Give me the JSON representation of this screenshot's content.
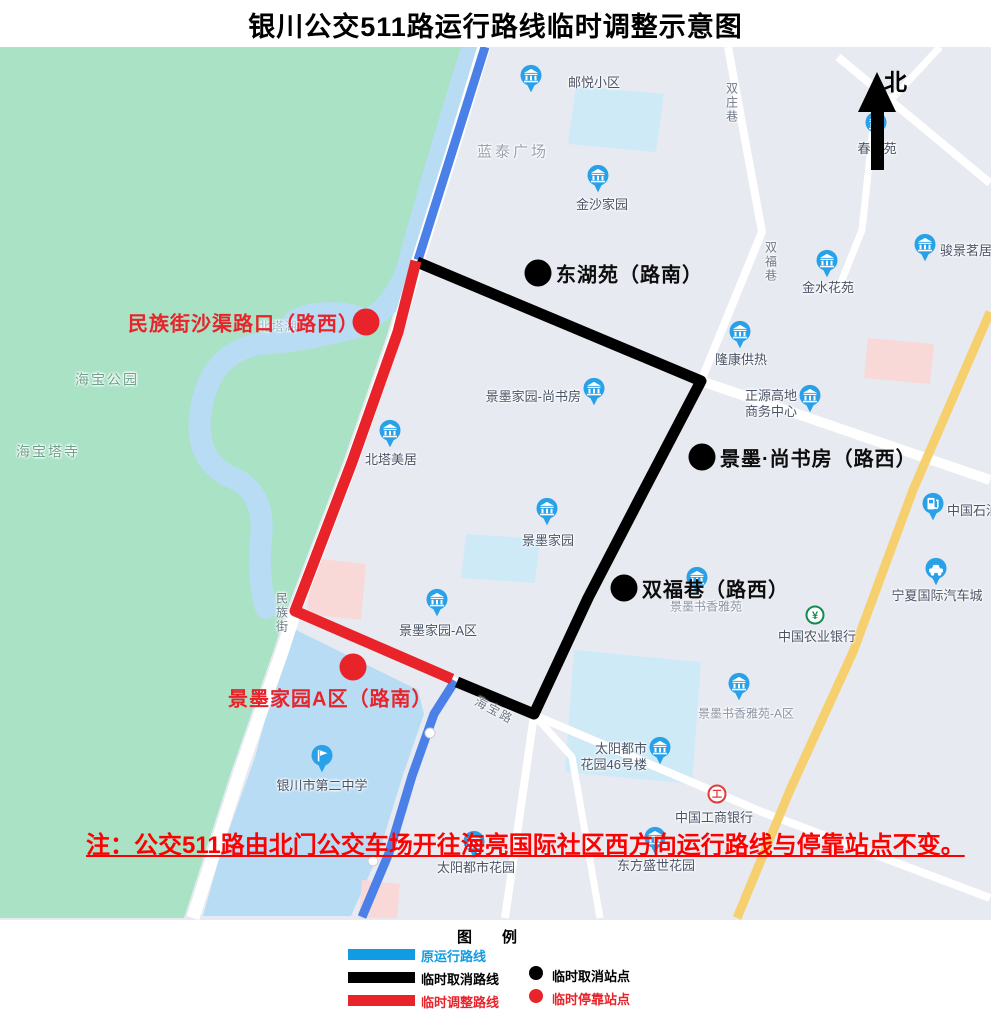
{
  "title": "银川公交511路运行路线临时调整示意图",
  "north": {
    "label": "北"
  },
  "note": "注：公交511路由北门公交车场开往海亮国际社区西方向运行路线与停靠站点不变。",
  "colors": {
    "legend_blue": "#119be2",
    "route_blue": "#4b80e8",
    "black": "#000000",
    "red": "#e8232a",
    "note_red": "#fe0000",
    "poi_blue": "#29a1e8",
    "bank_green": "#128a50",
    "bank_red": "#e23a3a"
  },
  "legend": {
    "title": "图　　例",
    "line_items": [
      {
        "label": "原运行路线",
        "color": "#119be2"
      },
      {
        "label": "临时取消路线",
        "color": "#000000"
      },
      {
        "label": "临时调整路线",
        "color": "#e8232a"
      }
    ],
    "dot_items": [
      {
        "label": "临时取消站点",
        "color": "#000000"
      },
      {
        "label": "临时停靠站点",
        "color": "#e8232a"
      }
    ]
  },
  "map": {
    "shapes": {
      "bg": "#e8eaf1",
      "park_fill": "#a9e2c5",
      "water_fill": "#b8dcf4",
      "cyan_fill": "#ceeaf7",
      "pink_fill": "#f9d9d7",
      "road_fill": "#ffffff",
      "yellow_fill": "#f6cf6e",
      "park": [
        [
          0,
          47
        ],
        [
          475,
          47
        ],
        [
          443,
          152
        ],
        [
          409,
          260
        ],
        [
          387,
          335
        ],
        [
          343,
          462
        ],
        [
          301,
          572
        ],
        [
          286,
          612
        ],
        [
          273,
          652
        ],
        [
          231,
          772
        ],
        [
          197,
          878
        ],
        [
          184,
          918
        ],
        [
          0,
          918
        ]
      ],
      "river": "M 470 55 Q 440 150 410 258 Q 398 310 352 328 Q 300 342 258 344 Q 206 355 200 418 Q 196 462 233 478 Q 266 492 261 540 Q 257 575 266 608",
      "lake": {
        "cx": 330,
        "cy": 322,
        "rx": 48,
        "ry": 20
      },
      "pond": [
        [
          292,
          628
        ],
        [
          418,
          690
        ],
        [
          424,
          714
        ],
        [
          402,
          778
        ],
        [
          379,
          853
        ],
        [
          351,
          916
        ],
        [
          203,
          916
        ],
        [
          220,
          855
        ],
        [
          255,
          757
        ],
        [
          284,
          650
        ]
      ],
      "cyan_blocks": [
        [
          [
            576,
            86
          ],
          [
            664,
            94
          ],
          [
            656,
            152
          ],
          [
            568,
            144
          ]
        ],
        [
          [
            466,
            534
          ],
          [
            540,
            539
          ],
          [
            535,
            583
          ],
          [
            461,
            578
          ]
        ],
        [
          [
            574,
            650
          ],
          [
            701,
            662
          ],
          [
            692,
            784
          ],
          [
            565,
            772
          ]
        ]
      ],
      "pink_blocks": [
        [
          [
            312,
            558
          ],
          [
            366,
            564
          ],
          [
            361,
            620
          ],
          [
            307,
            614
          ]
        ],
        [
          [
            868,
            338
          ],
          [
            934,
            344
          ],
          [
            930,
            384
          ],
          [
            864,
            378
          ]
        ],
        [
          [
            362,
            880
          ],
          [
            400,
            884
          ],
          [
            397,
            918
          ],
          [
            359,
            918
          ]
        ]
      ],
      "roads": [
        {
          "w": 13,
          "pts": [
            [
              484,
              47
            ],
            [
              452,
              152
            ],
            [
              418,
              260
            ],
            [
              396,
              335
            ],
            [
              352,
              462
            ],
            [
              310,
              572
            ],
            [
              295,
              612
            ],
            [
              282,
              652
            ],
            [
              240,
              772
            ],
            [
              206,
              878
            ],
            [
              193,
              918
            ]
          ]
        },
        {
          "w": 10,
          "pts": [
            [
              416,
              262
            ],
            [
              701,
              381
            ],
            [
              990,
              480
            ]
          ]
        },
        {
          "w": 8,
          "pts": [
            [
              728,
              47
            ],
            [
              762,
              232
            ],
            [
              701,
              381
            ],
            [
              643,
              492
            ],
            [
              588,
              598
            ],
            [
              534,
              715
            ],
            [
              505,
              918
            ]
          ]
        },
        {
          "w": 8,
          "pts": [
            [
              432,
              670
            ],
            [
              456,
              682
            ],
            [
              534,
              715
            ],
            [
              762,
              812
            ],
            [
              990,
              898
            ]
          ]
        },
        {
          "w": 8,
          "pts": [
            [
              838,
              57
            ],
            [
              990,
              183
            ]
          ]
        },
        {
          "w": 7,
          "pts": [
            [
              940,
              47
            ],
            [
              874,
              118
            ],
            [
              862,
              230
            ],
            [
              838,
              290
            ]
          ]
        },
        {
          "w": 7,
          "pts": [
            [
              534,
              715
            ],
            [
              572,
              757
            ],
            [
              600,
              918
            ]
          ]
        }
      ],
      "yellow_road": [
        [
          990,
          312
        ],
        [
          913,
          490
        ],
        [
          853,
          652
        ],
        [
          790,
          790
        ],
        [
          737,
          918
        ]
      ]
    },
    "routes": {
      "original": {
        "name": "原运行路线",
        "color": "#4b80e8",
        "width": 9,
        "segments": [
          [
            [
              485,
              47
            ],
            [
              452,
              152
            ],
            [
              418,
              260
            ]
          ],
          [
            [
              455,
              681
            ],
            [
              434,
              714
            ],
            [
              412,
              776
            ],
            [
              389,
              853
            ],
            [
              362,
              917
            ]
          ]
        ],
        "nodes": [
          [
            430,
            733
          ],
          [
            373,
            861
          ]
        ]
      },
      "cancelled": {
        "name": "临时取消路线",
        "color": "#000000",
        "width": 11,
        "path": [
          [
            417,
            262
          ],
          [
            701,
            381
          ],
          [
            643,
            492
          ],
          [
            588,
            598
          ],
          [
            534,
            714
          ],
          [
            457,
            682
          ]
        ]
      },
      "adjusted": {
        "name": "临时调整路线",
        "color": "#e8232a",
        "width": 11,
        "path": [
          [
            416,
            261
          ],
          [
            398,
            332
          ],
          [
            352,
            462
          ],
          [
            310,
            572
          ],
          [
            295,
            611
          ],
          [
            452,
            679
          ]
        ]
      }
    },
    "stations": {
      "cancelled": [
        {
          "name": "东湖苑（路南）",
          "dot": [
            538,
            273
          ],
          "label_anchor": [
            556,
            273
          ]
        },
        {
          "name": "景墨·尚书房（路西）",
          "dot": [
            702,
            457
          ],
          "label_anchor": [
            720,
            457
          ]
        },
        {
          "name": "双福巷（路西）",
          "dot": [
            624,
            588
          ],
          "label_anchor": [
            642,
            588
          ]
        }
      ],
      "temporary": [
        {
          "name": "民族街沙渠路口（路西）",
          "dot": [
            366,
            322
          ],
          "label_anchor": [
            128,
            322
          ]
        },
        {
          "name": "景墨家园A区（路南）",
          "dot": [
            353,
            667
          ],
          "label_anchor": [
            228,
            697
          ]
        }
      ]
    },
    "area_labels": [
      {
        "text": "蓝泰广场",
        "pos": [
          513,
          153
        ],
        "cls": "area"
      },
      {
        "text": "海宝公园",
        "pos": [
          107,
          380
        ],
        "cls": "park-lbl"
      },
      {
        "text": "海宝塔寺",
        "pos": [
          48,
          452
        ],
        "cls": "park-lbl"
      },
      {
        "text": "北塔湖",
        "pos": [
          278,
          327
        ],
        "cls": "water-lbl"
      }
    ],
    "street_labels": [
      {
        "text": "双庄巷",
        "pos": [
          731,
          103
        ],
        "vertical": true
      },
      {
        "text": "双福巷",
        "pos": [
          770,
          262
        ],
        "vertical": true
      },
      {
        "text": "民族街",
        "pos": [
          281,
          613
        ],
        "vertical": true
      },
      {
        "text": "海宝路",
        "pos": [
          494,
          711
        ],
        "angle": 28
      }
    ],
    "pois": [
      {
        "type": "building",
        "icon": [
          531,
          82
        ],
        "label": [
          568,
          83
        ],
        "side": "right",
        "text": "邮悦小区"
      },
      {
        "type": "building",
        "icon": [
          598,
          182
        ],
        "label": [
          602,
          205
        ],
        "side": "below",
        "text": "金沙家园"
      },
      {
        "type": "building",
        "icon": [
          876,
          129
        ],
        "label": [
          877,
          149
        ],
        "side": "below",
        "text": "春　苑"
      },
      {
        "type": "building",
        "icon": [
          827,
          267
        ],
        "label": [
          828,
          288
        ],
        "side": "below",
        "text": "金水花苑"
      },
      {
        "type": "building",
        "icon": [
          925,
          251
        ],
        "label": [
          940,
          251
        ],
        "side": "right",
        "text": "骏景茗居"
      },
      {
        "type": "building",
        "icon": [
          740,
          338
        ],
        "label": [
          741,
          360
        ],
        "side": "below",
        "text": "隆康供热"
      },
      {
        "type": "building",
        "icon": [
          810,
          402
        ],
        "label": [
          797,
          404
        ],
        "side": "left",
        "text": "正源高地\n商务中心"
      },
      {
        "type": "building",
        "icon": [
          594,
          395
        ],
        "label": [
          581,
          397
        ],
        "side": "left",
        "text": "景墨家园-尚书房"
      },
      {
        "type": "building",
        "icon": [
          390,
          437
        ],
        "label": [
          391,
          460
        ],
        "side": "below",
        "text": "北塔美居"
      },
      {
        "type": "building",
        "icon": [
          547,
          515
        ],
        "label": [
          548,
          541
        ],
        "side": "below",
        "text": "景墨家园"
      },
      {
        "type": "building",
        "icon": [
          697,
          584
        ],
        "label": [
          706,
          607
        ],
        "side": "below",
        "text": "景墨书香雅苑",
        "small": true
      },
      {
        "type": "building",
        "icon": [
          437,
          606
        ],
        "label": [
          438,
          631
        ],
        "side": "below",
        "text": "景墨家园-A区"
      },
      {
        "type": "fuel",
        "icon": [
          933,
          510
        ],
        "label": [
          947,
          511
        ],
        "side": "right",
        "text": "中国石油"
      },
      {
        "type": "car",
        "icon": [
          936,
          575
        ],
        "label": [
          937,
          596
        ],
        "side": "below",
        "text": "宁夏国际汽车城"
      },
      {
        "type": "bank-green",
        "icon": [
          815,
          618
        ],
        "label": [
          817,
          637
        ],
        "side": "below",
        "text": "中国农业银行"
      },
      {
        "type": "building",
        "icon": [
          739,
          690
        ],
        "label": [
          746,
          714
        ],
        "side": "below",
        "text": "景墨书香雅苑-A区",
        "small": true
      },
      {
        "type": "building",
        "icon": [
          660,
          754
        ],
        "label": [
          647,
          757
        ],
        "side": "left",
        "text": "太阳都市\n花园46号楼"
      },
      {
        "type": "school",
        "icon": [
          322,
          762
        ],
        "label": [
          322,
          786
        ],
        "side": "below",
        "text": "银川市第二中学"
      },
      {
        "type": "building",
        "icon": [
          474,
          848
        ],
        "label": [
          476,
          868
        ],
        "side": "below",
        "text": "太阳都市花园"
      },
      {
        "type": "building",
        "icon": [
          655,
          844
        ],
        "label": [
          656,
          866
        ],
        "side": "below",
        "text": "东方盛世花园"
      },
      {
        "type": "bank-red",
        "icon": [
          717,
          797
        ],
        "label": [
          714,
          818
        ],
        "side": "below",
        "text": "中国工商银行"
      }
    ]
  }
}
